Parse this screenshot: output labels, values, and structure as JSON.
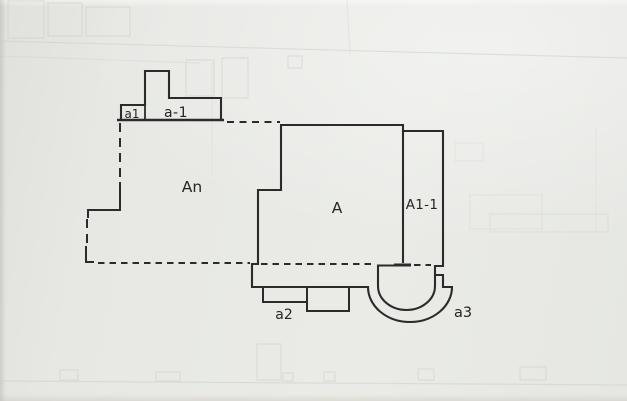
{
  "drawing": {
    "labels": {
      "a1": "a1",
      "a_1": "a-1",
      "an": "An",
      "a": "A",
      "a1_1": "A1-1",
      "a2": "a2",
      "a3": "a3"
    },
    "colors": {
      "paper": "#e8e9e5",
      "ink": "#2b2b2b",
      "ghost": "#cdd1c8"
    }
  }
}
